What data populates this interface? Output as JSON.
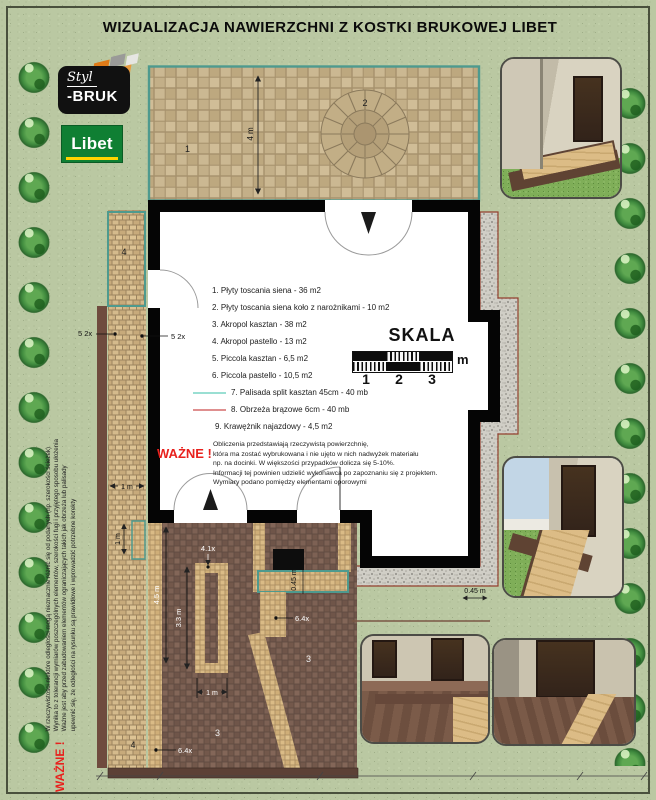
{
  "page": {
    "title": "WIZUALIZACJA NAWIERZCHNI Z KOSTKI BRUKOWEJ LIBET"
  },
  "logos": {
    "stylbruk_top": "Styl",
    "stylbruk_bottom": "-BRUK",
    "libet": "Libet"
  },
  "legend": {
    "items": [
      {
        "label": "1. Płyty toscania siena - 36 m2"
      },
      {
        "label": "2. Płyty toscania siena koło z narożnikami - 10 m2"
      },
      {
        "label": "3. Akropol kasztan - 38 m2"
      },
      {
        "label": "4. Akropol pastello - 13 m2"
      },
      {
        "label": "5. Piccola kasztan - 6,5 m2"
      },
      {
        "label": "6. Piccola pastello - 10,5 m2"
      },
      {
        "label": "7. Palisada split kasztan 45cm - 40 mb"
      },
      {
        "label": "8. Obrzeża brązowe 6cm - 40 mb"
      },
      {
        "label": "9. Krawężnik najazdowy - 4,5 m2"
      }
    ],
    "palisada_swatch_color": "#9adfd3",
    "obrzeza_swatch_color": "#df8f8f"
  },
  "scale": {
    "title": "SKALA",
    "ticks": [
      "1",
      "2",
      "3"
    ],
    "unit": "m"
  },
  "notes": {
    "important_label": "WAŻNE !",
    "calc_note": "Obliczenia przedstawiają rzeczywistą powierzchnię,\nktóra ma zostać wybrukowana i nie ujęto w nich nadwyżek materiału\nnp. na docinki. W większości przypadków dolicza się 5-10%.\nInformacji tej powinien udzielić wykonawca po zapoznaniu się z projektem.\nWymiary podano pomiędzy elementami oporowymi",
    "side": {
      "label": "WAŻNE !",
      "lines": [
        "W rzeczywistości niektóre odległości mogą nieznacznie różnić się od podanych (np. szerokości ścieżek)",
        "Wynika to z tolerancji wymiarów poszczególnych elementów, szerokości fugi i przyjętego sposobu ułożenia",
        "Ważne jest aby przed zabudowaniem elementów ograniczających takich jak obrzeża lub palisady",
        "upewnić się, że odległości na rysunku są prawidłowe i wprowadzić potrzebne korekty"
      ]
    }
  },
  "plan": {
    "area_labels": {
      "terrace": "1",
      "circle": "2",
      "driveway_a": "3",
      "driveway_b": "3",
      "path_top": "4",
      "path_bottom": "4"
    },
    "dims": {
      "terrace_depth": "4 m",
      "edging_left": "5 2x",
      "edging_right": "5 2x",
      "path_width": "1 m",
      "palisade_len": "1 m",
      "drive_len": "4.5 m",
      "inset_len": "3.3 m",
      "inset_label": "4.1x",
      "inset_width": "1 m",
      "band_label_a": "6.4x",
      "band_label_b": "6.4x",
      "gravel_w_side": "0.45 m",
      "gravel_w_bottom": "0.45 m"
    }
  },
  "colors": {
    "teal_outline": "#4e9a8e",
    "gravel_border": "#93402f",
    "warning_red": "#e8211d",
    "libet_green": "#0f7f33",
    "libet_yellow": "#ffd400"
  }
}
